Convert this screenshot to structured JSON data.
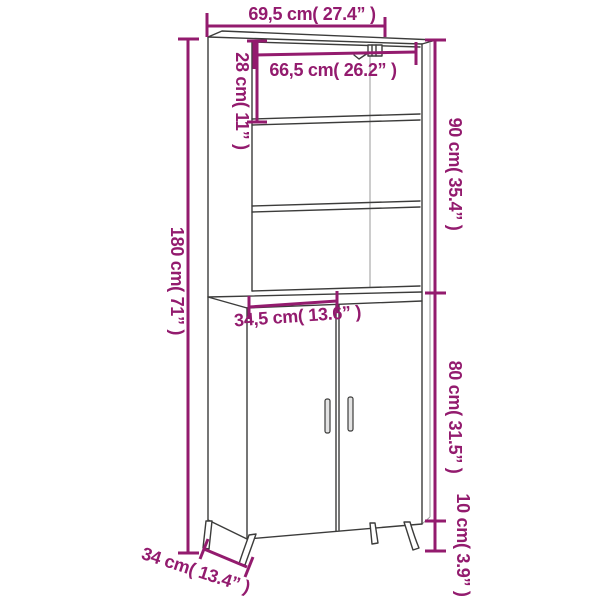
{
  "subject": "highboard-cabinet-dimension-diagram",
  "colors": {
    "dimension": "#931B6E",
    "outline": "#3C3C3B",
    "background": "#FFFFFF"
  },
  "labels": {
    "top_width": "69,5 cm( 27.4” )",
    "inner_width": "66,5 cm( 26.2” )",
    "top_compartment_height": "28 cm( 11” )",
    "upper_section_height": "90 cm( 35.4” )",
    "total_height": "180 cm( 71” )",
    "door_width": "34,5 cm( 13.6” )",
    "lower_section_height": "80 cm( 31.5” )",
    "leg_height": "10 cm( 3.9” )",
    "depth": "34 cm( 13.4” )"
  }
}
